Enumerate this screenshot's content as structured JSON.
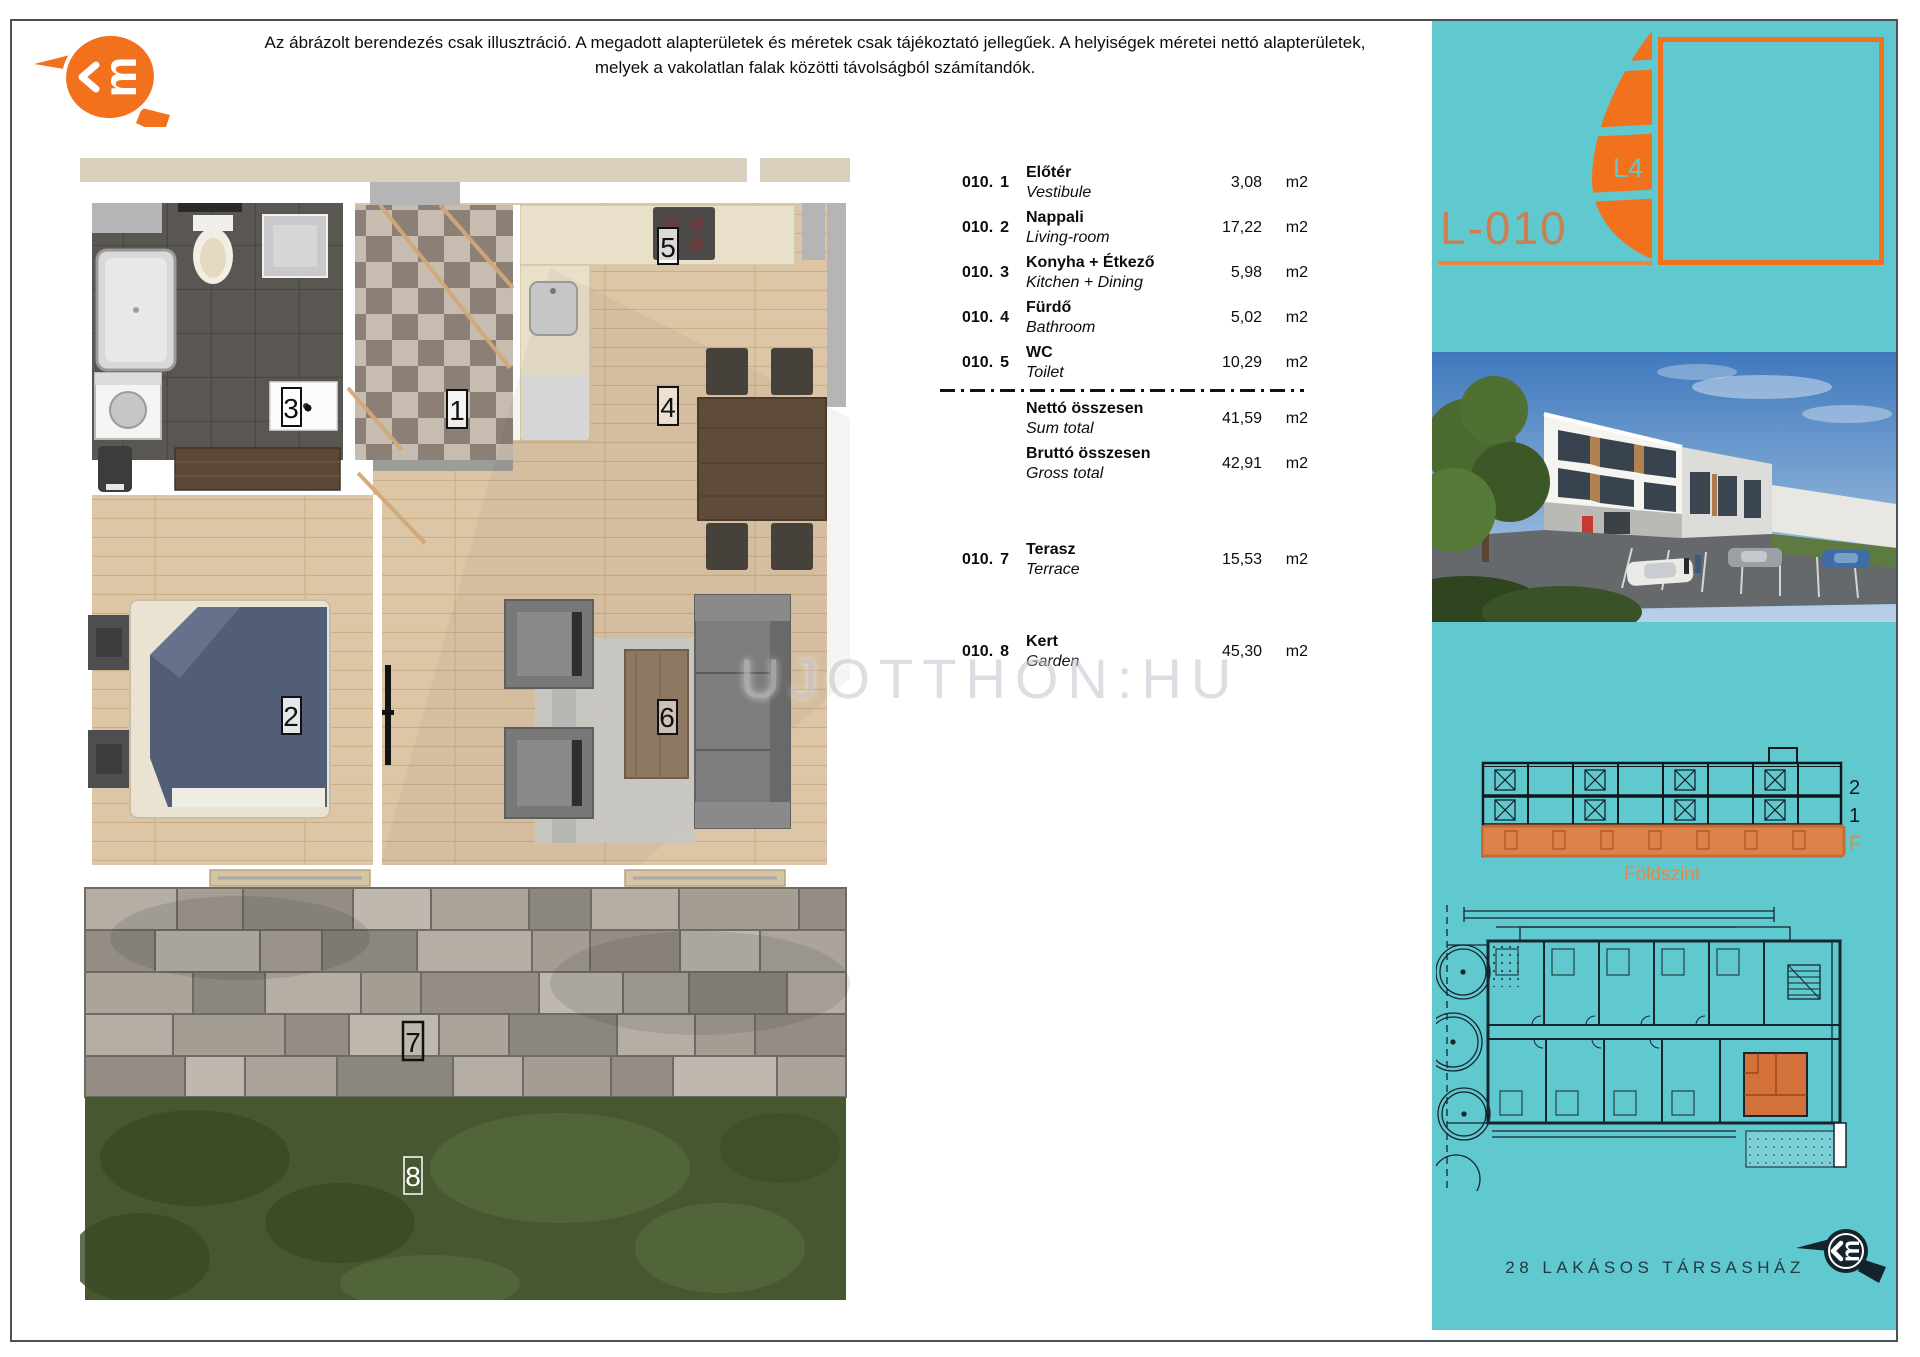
{
  "header": {
    "disclaimer_line1": "Az ábrázolt berendezés csak illusztráció. A megadott alapterületek és méretek csak tájékoztató jellegűek. A helyiségek méretei nettó alapterületek,",
    "disclaimer_line2": "melyek a vakolatlan falak közötti távolságból számítandók."
  },
  "watermark": {
    "text": "UJOTTHON:HU"
  },
  "plan": {
    "labels": [
      "1",
      "2",
      "3",
      "4",
      "5",
      "6",
      "7",
      "8"
    ]
  },
  "table": {
    "rows": [
      {
        "code": "010.",
        "num": "1",
        "name_hu": "Előtér",
        "name_en": "Vestibule",
        "value": "3,08",
        "unit": "m2"
      },
      {
        "code": "010.",
        "num": "2",
        "name_hu": "Nappali",
        "name_en": "Living-room",
        "value": "17,22",
        "unit": "m2"
      },
      {
        "code": "010.",
        "num": "3",
        "name_hu": "Konyha + Étkező",
        "name_en": "Kitchen + Dining",
        "value": "5,98",
        "unit": "m2"
      },
      {
        "code": "010.",
        "num": "4",
        "name_hu": "Fürdő",
        "name_en": "Bathroom",
        "value": "5,02",
        "unit": "m2"
      },
      {
        "code": "010.",
        "num": "5",
        "name_hu": "WC",
        "name_en": "Toilet",
        "value": "10,29",
        "unit": "m2"
      }
    ],
    "totals": [
      {
        "code": "",
        "num": "",
        "name_hu": "Nettó összesen",
        "name_en": "Sum total",
        "value": "41,59",
        "unit": "m2"
      },
      {
        "code": "",
        "num": "",
        "name_hu": "Bruttó összesen",
        "name_en": "Gross total",
        "value": "42,91",
        "unit": "m2"
      }
    ],
    "extras": [
      {
        "code": "010.",
        "num": "7",
        "name_hu": "Terasz",
        "name_en": "Terrace",
        "value": "15,53",
        "unit": "m2"
      },
      {
        "code": "010.",
        "num": "8",
        "name_hu": "Kert",
        "name_en": "Garden",
        "value": "45,30",
        "unit": "m2"
      }
    ]
  },
  "sidebar": {
    "unit_code": "L-010",
    "sail_label": "L4",
    "section": {
      "floor_labels": [
        "2",
        "1",
        "F"
      ],
      "caption": "Földszint"
    },
    "footer": {
      "building_name": "28 LAKÁSOS TÁRSASHÁZ"
    },
    "colors": {
      "teal": "#60c8cf",
      "orange": "#f2711c",
      "orange_muted": "#cd7f4e"
    }
  }
}
